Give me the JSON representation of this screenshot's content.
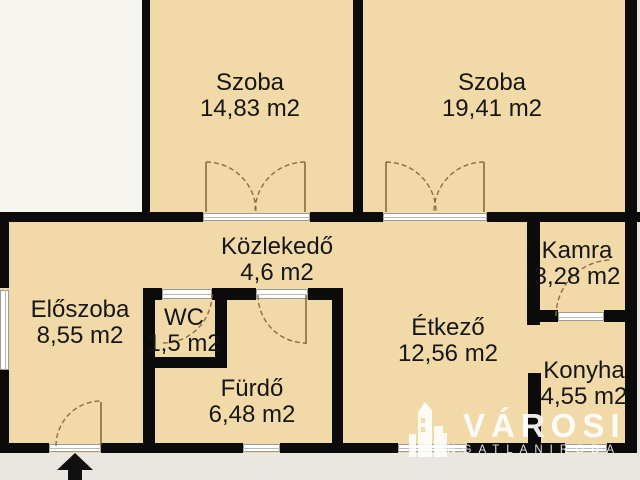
{
  "plan_title": "apartment-floorplan",
  "rooms": [
    {
      "name": "Szoba",
      "area": "14,83 m2"
    },
    {
      "name": "Szoba",
      "area": "19,41 m2"
    },
    {
      "name": "Közlekedő",
      "area": "4,6 m2"
    },
    {
      "name": "Kamra",
      "area": "3,28 m2"
    },
    {
      "name": "Előszoba",
      "area": "8,55 m2"
    },
    {
      "name": "WC",
      "area": "1,5 m2"
    },
    {
      "name": "Fürdő",
      "area": "6,48 m2"
    },
    {
      "name": "Étkező",
      "area": "12,56 m2"
    },
    {
      "name": "Konyha",
      "area": "4,55 m2"
    }
  ],
  "watermark": {
    "brand": "VÁROSI",
    "subtitle": "INGATLANIRODA"
  },
  "colors": {
    "floor": "#f2d9a8",
    "wall": "#0b0b0b",
    "exterior_top": "#f6f5f0",
    "exterior_bottom": "#eae7e2",
    "watermark": "#ffffff"
  }
}
